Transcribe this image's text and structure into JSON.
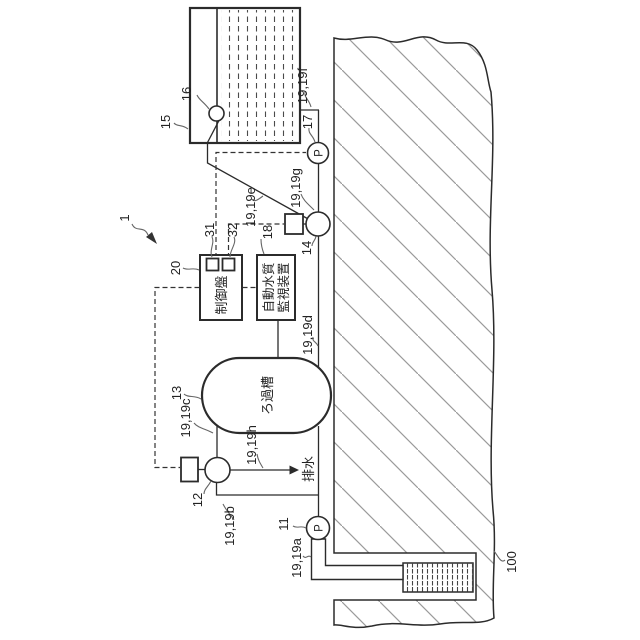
{
  "refs": {
    "system": "1",
    "ground": "100",
    "well_pump": "11",
    "switch_valve": "12",
    "filter_tank": "13",
    "supply_valve": "14",
    "storage_tank": "15",
    "float": "16",
    "transfer_pump": "17",
    "monitor": "18",
    "control_panel": "20",
    "lamp1": "31",
    "lamp2": "32"
  },
  "pipe_refs": {
    "a": "19,19a",
    "b": "19,19b",
    "c": "19,19c",
    "d": "19,19d",
    "e": "19,19e",
    "f": "19,19f",
    "g": "19,19g",
    "h": "19,19h"
  },
  "labels": {
    "control_panel": "制御盤",
    "monitor_line1": "自動水質",
    "monitor_line2": "監視装置",
    "filter_tank": "ろ過槽",
    "drain": "排水",
    "pump_symbol": "P"
  },
  "colors": {
    "line": "#2b2b2b",
    "hatch": "#9a9a9a",
    "water_dash": "#4a4a4a",
    "background": "#ffffff"
  }
}
